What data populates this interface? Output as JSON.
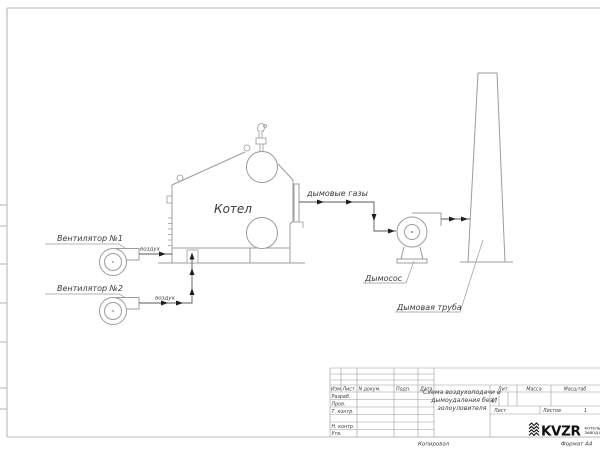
{
  "colors": {
    "frame": "#b9b9b9",
    "grid": "#9a9a9a",
    "equipment": "#9c9c9c",
    "duct": "#5a5a5a",
    "arrow": "#1f1f1f",
    "leader": "#9a9a9a",
    "text": "#3a3a3a",
    "logo": "#111111"
  },
  "diagram": {
    "boiler_label": "Котел",
    "fan1_label": "Вентилятор №1",
    "fan2_label": "Вентилятор №2",
    "air_label": "воздух",
    "flue_gas_label": "дымовые газы",
    "exhauster_label": "Дымосос",
    "chimney_label": "Дымовая труба"
  },
  "title_block": {
    "header_cols": [
      "Изм.",
      "Лист",
      "N докум.",
      "Подп.",
      "Дата"
    ],
    "row_labels": [
      "Разраб.",
      "Пров.",
      "Т. контр.",
      "Н. контр.",
      "Утв."
    ],
    "title_lines": [
      "Схема воздухоподачи и",
      "дымоудаления без",
      "золоуловителя"
    ],
    "lit_label": "Лит.",
    "lit_value": "И",
    "mass_label": "Масса",
    "scale_label": "Масштаб",
    "sheet_label": "Лист",
    "sheets_label": "Листов",
    "sheets_value": "1",
    "logo_text": "KVZR",
    "company_lines": [
      "КОТЕЛЬНЫЙ",
      "ЗАВОД РЭ"
    ],
    "copied_label": "Копировал",
    "format_label": "Формат А4"
  }
}
